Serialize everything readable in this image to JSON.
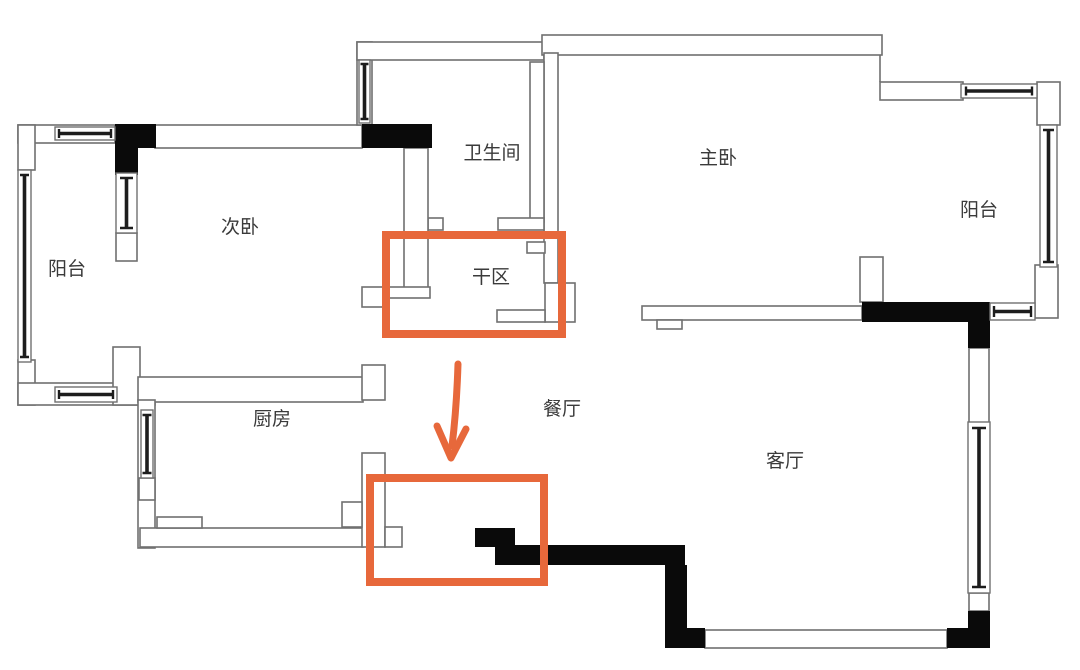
{
  "page": {
    "type": "apartment-floor-plan"
  },
  "rooms": {
    "balcony_left": {
      "label": "阳台"
    },
    "second_bedroom": {
      "label": "次卧"
    },
    "bathroom": {
      "label": "卫生间"
    },
    "dry_area": {
      "label": "干区"
    },
    "master_bedroom": {
      "label": "主卧"
    },
    "balcony_right": {
      "label": "阳台"
    },
    "kitchen": {
      "label": "厨房"
    },
    "dining_room": {
      "label": "餐厅"
    },
    "living_room": {
      "label": "客厅"
    }
  },
  "annotations": {
    "highlight_color": "#e7683b",
    "arrow_direction": "down",
    "highlight_count": 2
  },
  "colors": {
    "wall_line": "#707070",
    "solid_wall": "#0a0a0a",
    "label_text": "#3a3a3a",
    "background": "#ffffff"
  }
}
